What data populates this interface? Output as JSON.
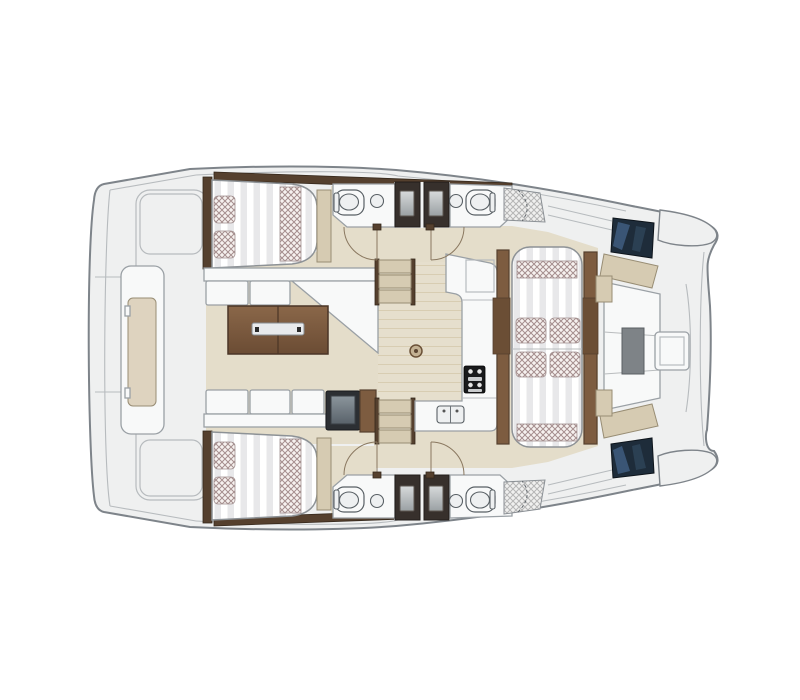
{
  "canvas": {
    "width": 800,
    "height": 700,
    "background": "#ffffff"
  },
  "diagram": {
    "type": "floor-plan",
    "subject": "catamaran-yacht-accommodation-plan-top-view",
    "orientation": "bow-right-stern-left",
    "regions": [
      "aft-swim-platform",
      "aft-bench",
      "port-aft-cabin-berth",
      "starboard-aft-cabin-berth",
      "salon-sofa",
      "salon-folding-table",
      "salon-bench",
      "refrigerator-box",
      "galley-counter",
      "stove",
      "double-sink",
      "floor-hatch",
      "companionway-stairs-port",
      "companionway-stairs-starboard",
      "head-port-inner",
      "head-port-outer",
      "head-starboard-inner",
      "head-starboard-outer",
      "shower-port",
      "shower-starboard",
      "dinette-bench",
      "dinette-cushions",
      "forward-cockpit-seating",
      "forward-cockpit-table",
      "bow-hatch-window-port",
      "bow-hatch-window-starboard"
    ],
    "counts": {
      "berths": 2,
      "toilets": 4,
      "sinks-bathroom": 4,
      "showers": 2,
      "stair-flights": 2
    }
  },
  "colors": {
    "page-bg": "#ffffff",
    "outline": "#7e848a",
    "outline-light": "#b7bbbe",
    "outline-soft": "#9aa0a5",
    "deck": "#eff0f0",
    "white-surface": "#f8f9f9",
    "floor": "#e4ddca",
    "cushion": "#d6cbb2",
    "cushion-light": "#ded3bf",
    "cushion-edge": "#988d74",
    "wood-brown": "#7d5c40",
    "wood-mid": "#6b4e35",
    "wood-dark": "#55402e",
    "wood-darker": "#35281c",
    "mattress": "#ffffff",
    "mattress-stripe": "#e8e8ea",
    "pillow-bg": "#f6f1ef",
    "pillow-line": "#a58e8e",
    "shower-line": "#b5b5b5",
    "window-navy": "#1e2c3a",
    "window-blue": "#3f5d80",
    "window-edge": "#0d141b",
    "fixture-edge": "#596065",
    "door-arc": "#8a7860",
    "stove": "#191a1c",
    "steel": "#e8eaec",
    "box-dark": "#2c2f33"
  }
}
